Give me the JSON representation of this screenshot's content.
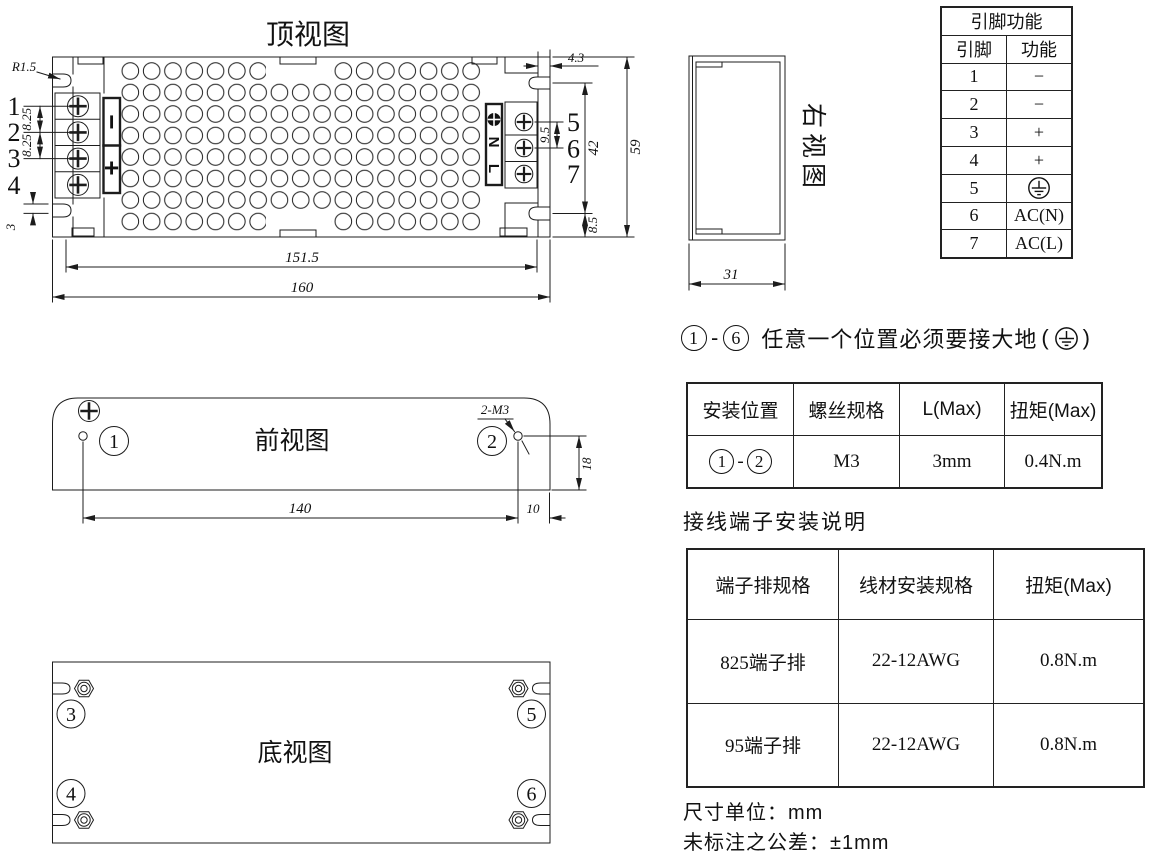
{
  "views": {
    "top": {
      "title": "顶视图",
      "left_terminals": [
        "1",
        "2",
        "3",
        "4"
      ],
      "right_terminals": [
        "5",
        "6",
        "7"
      ],
      "polarity": {
        "minus": "−",
        "plus": "+"
      },
      "ac_labels": {
        "l": "L",
        "n": "N"
      },
      "dims": {
        "corner_radius": "R1.5",
        "pitch_a": "8.25",
        "pitch_b": "8.25",
        "offset": "3",
        "inner_width": "151.5",
        "outer_width": "160",
        "step": "4.3",
        "pitch_right": "9.5",
        "slot_span": "42",
        "height": "59",
        "bottom_offset": "8.5"
      }
    },
    "front": {
      "title": "前视图",
      "hole1": "1",
      "hole2": "2",
      "thread": "2-M3",
      "dims": {
        "width": "140",
        "right": "10",
        "height": "18"
      }
    },
    "bottom": {
      "title": "底视图",
      "hole3": "3",
      "hole4": "4",
      "hole5": "5",
      "hole6": "6"
    },
    "right": {
      "title": "右视图",
      "dims": {
        "depth": "31"
      }
    }
  },
  "pin_table": {
    "title": "引脚功能",
    "col_pin": "引脚",
    "col_fn": "功能",
    "rows": [
      {
        "pin": "1",
        "fn": "−"
      },
      {
        "pin": "2",
        "fn": "−"
      },
      {
        "pin": "3",
        "fn": "+"
      },
      {
        "pin": "4",
        "fn": "+"
      },
      {
        "pin": "5",
        "fn": "",
        "symbol": "earth-ground"
      },
      {
        "pin": "6",
        "fn": "AC(N)"
      },
      {
        "pin": "7",
        "fn": "AC(L)"
      }
    ]
  },
  "ground_note": {
    "start": "1",
    "dash": "-",
    "end": "6",
    "body": "任意一个位置必须要接大地",
    "open": "(",
    "close": ")",
    "symbol": "earth-ground"
  },
  "install_table": {
    "headers": [
      "安装位置",
      "螺丝规格",
      "L(Max)",
      "扭矩(Max)"
    ],
    "row": {
      "pos_start": "1",
      "pos_dash": "-",
      "pos_end": "2",
      "screw": "M3",
      "l_max": "3mm",
      "torque": "0.4N.m"
    }
  },
  "terminal_section_title": "接线端子安装说明",
  "terminal_table": {
    "headers": [
      "端子排规格",
      "线材安装规格",
      "扭矩(Max)"
    ],
    "rows": [
      {
        "spec": "825端子排",
        "wire": "22-12AWG",
        "torque": "0.8N.m"
      },
      {
        "spec": "95端子排",
        "wire": "22-12AWG",
        "torque": "0.8N.m"
      }
    ]
  },
  "footer": {
    "unit_note": "尺寸单位：mm",
    "tolerance_note": "未标注之公差：±1mm"
  }
}
